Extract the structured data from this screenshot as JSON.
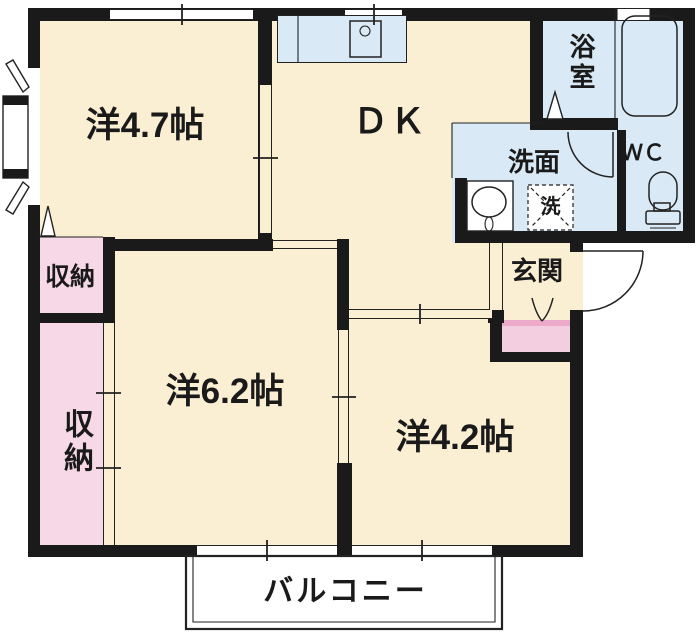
{
  "plan": {
    "rooms": {
      "west47": {
        "label": "洋4.7帖"
      },
      "dk": {
        "label": "ＤＫ"
      },
      "bath": {
        "label": "浴室"
      },
      "washroom": {
        "label": "洗面"
      },
      "wc": {
        "label": "ＷＣ"
      },
      "washer": {
        "label": "洗"
      },
      "storage_top": {
        "label": "収納"
      },
      "storage_tall": {
        "label": "収納"
      },
      "genkan": {
        "label": "玄関"
      },
      "west62": {
        "label": "洋6.2帖"
      },
      "west42": {
        "label": "洋4.2帖"
      },
      "balcony": {
        "label": "バルコニー"
      }
    }
  },
  "colors": {
    "wall": "#1a1a1a",
    "outline": "#222222",
    "floor": "#faeed3",
    "wet": "#d9eaf6",
    "storage": "#f7d8e6",
    "step": "#f3cee1",
    "step_edge": "#eda9c9",
    "white": "#ffffff"
  }
}
